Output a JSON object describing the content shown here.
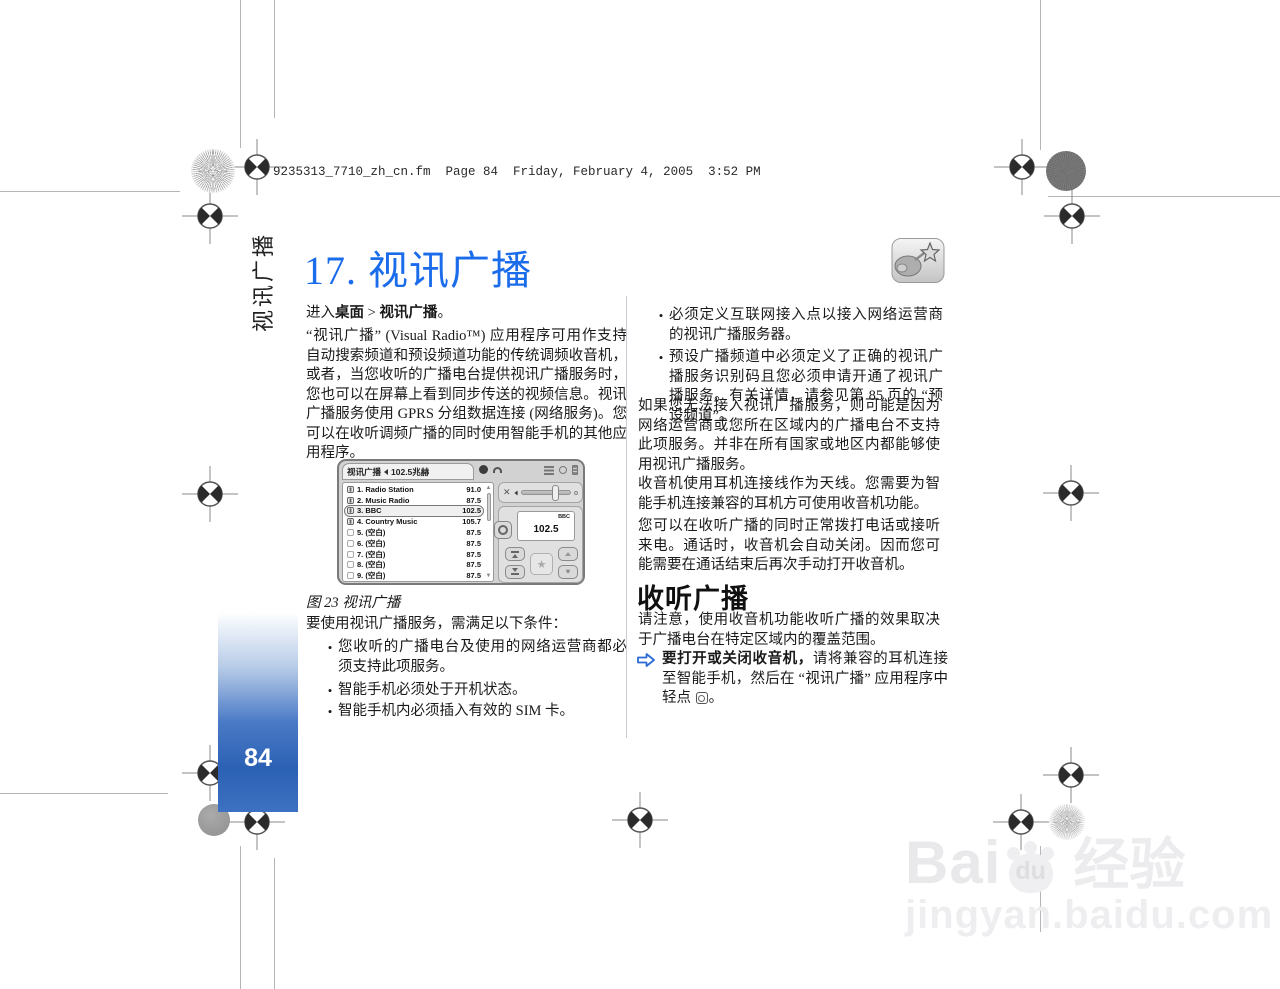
{
  "page": {
    "header_line": "9235313_7710_zh_cn.fm  Page 84  Friday, February 4, 2005  3:52 PM",
    "sidebar_label": "视讯广播",
    "page_number": "84",
    "chapter_title": "17. 视讯广播"
  },
  "colors": {
    "title_blue": "#1b6ceb",
    "sidebar_bar_blue": "#2e64b6",
    "note_arrow_blue": "#2b6bd3"
  },
  "left_column": {
    "intro_prefix": "进入",
    "intro_bold1": "桌面",
    "intro_sep": " > ",
    "intro_bold2": "视讯广播",
    "intro_suffix": "。",
    "para1": "“视讯广播” (Visual Radio™) 应用程序可用作支持自动搜索频道和预设频道功能的传统调频收音机，或者，当您收听的广播电台提供视讯广播服务时，您也可以在屏幕上看到同步传送的视频信息。视讯广播服务使用 GPRS 分组数据连接 (网络服务)。您可以在收听调频广播的同时使用智能手机的其他应用程序。",
    "figure_caption": "图 23 视讯广播",
    "requirements_intro": "要使用视讯广播服务，需满足以下条件：",
    "bullets": [
      "您收听的广播电台及使用的网络运营商都必须支持此项服务。",
      "智能手机必须处于开机状态。",
      "智能手机内必须插入有效的 SIM 卡。"
    ]
  },
  "right_column": {
    "bullets": [
      "必须定义互联网接入点以接入网络运营商的视讯广播服务器。",
      "预设广播频道中必须定义了正确的视讯广播服务识别码且您必须申请开通了视讯广播服务。有关详情，请参见第 85 页的 “预设频道”。"
    ],
    "para1": "如果您无法接入视讯广播服务，则可能是因为网络运营商或您所在区域内的广播电台不支持此项服务。并非在所有国家或地区内都能够使用视讯广播服务。",
    "para2": "收音机使用耳机连接线作为天线。您需要为智能手机连接兼容的耳机方可使用收音机功能。",
    "para3": "您可以在收听广播的同时正常拨打电话或接听来电。通话时，收音机会自动关闭。因而您可能需要在通话结束后再次手动打开收音机。",
    "section_heading": "收听广播",
    "para4": "请注意，使用收音机功能收听广播的效果取决于广播电台在特定区域内的覆盖范围。",
    "note_bold": "要打开或关闭收音机，",
    "note_text": "请将兼容的耳机连接至智能手机，然后在 “视讯广播” 应用程序中轻点 ",
    "note_suffix": "。"
  },
  "phone": {
    "app_title": "视讯广播",
    "tuned_freq": "102.5兆赫",
    "display_station": "BBC",
    "display_freq": "102.5",
    "stations": [
      {
        "num": "1.",
        "name": "Radio Station",
        "freq": "91.0",
        "preset": true,
        "selected": false
      },
      {
        "num": "2.",
        "name": "Music Radio",
        "freq": "87.5",
        "preset": true,
        "selected": false
      },
      {
        "num": "3.",
        "name": "BBC",
        "freq": "102.5",
        "preset": true,
        "selected": true
      },
      {
        "num": "4.",
        "name": "Country Music",
        "freq": "105.7",
        "preset": true,
        "selected": false
      },
      {
        "num": "5.",
        "name": "(空白)",
        "freq": "87.5",
        "preset": false,
        "selected": false
      },
      {
        "num": "6.",
        "name": "(空白)",
        "freq": "87.5",
        "preset": false,
        "selected": false
      },
      {
        "num": "7.",
        "name": "(空白)",
        "freq": "87.5",
        "preset": false,
        "selected": false
      },
      {
        "num": "8.",
        "name": "(空白)",
        "freq": "87.5",
        "preset": false,
        "selected": false
      },
      {
        "num": "9.",
        "name": "(空白)",
        "freq": "87.5",
        "preset": false,
        "selected": false
      }
    ]
  },
  "watermark": {
    "brand_latin": "Bai",
    "brand_paw": "du",
    "brand_cjk": "经验",
    "url": "jingyan.baidu.com"
  }
}
